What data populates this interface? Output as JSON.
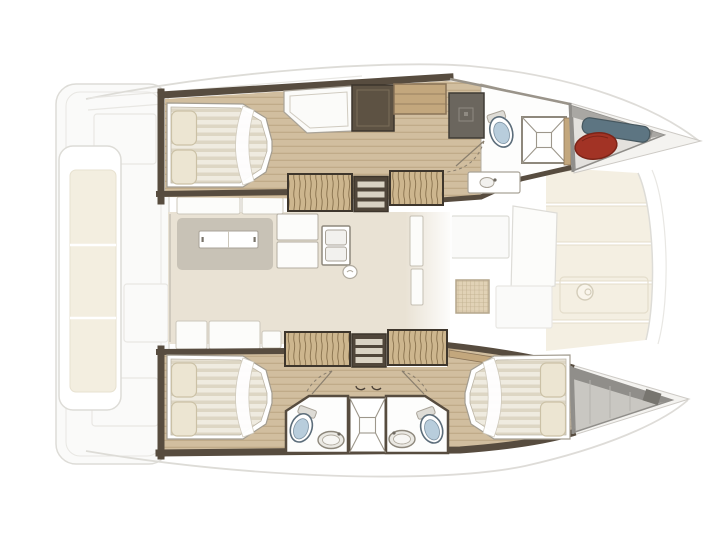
{
  "title": "Catamaran yacht interior layout floor plan, top-down view, bow to the right",
  "boat": {
    "type_label": "catamaran-floor-plan",
    "orientation": "bow-right",
    "double_beds": 3,
    "toilets": 3,
    "shower_cubicles": 2,
    "staircases": 2,
    "salon_features": [
      "dining-table",
      "settee-seats",
      "galley-double-sink",
      "galley-counters",
      "tall-cabinet"
    ],
    "port_hull_features": [
      "aft-double-bed-cabin",
      "two-pillows",
      "desk-seat",
      "wardrobe",
      "dark-cabinet",
      "staircase",
      "bathroom-toilet",
      "vanity-sink",
      "shower-cubicle",
      "bow-storage-with-red-fender-and-blue-roll"
    ],
    "starboard_hull_features": [
      "aft-double-bed-cabin",
      "staircase",
      "aft-bathroom-toilet-sink",
      "central-shower-cubicle",
      "forward-bathroom-toilet-sink",
      "forward-double-bed-cabin",
      "bow-locker"
    ],
    "exterior_features": [
      "stern-platform",
      "aft-cockpit-bench-with-cushions",
      "sheer-lines",
      "foredeck-cream-panels",
      "deck-fitting",
      "forward-cockpit-panels",
      "trampoline-mesh"
    ]
  },
  "colors": {
    "bg": "#ffffff",
    "wall": "#574c3f",
    "wall_light": "#6e6254",
    "wood": "#d1be9f",
    "wood_line": "#c0ab89",
    "stairs_bg": "#cdb68e",
    "stairs_line": "#87704c",
    "stairs_border": "#3e362c",
    "shelf_tan": "#c3a77d",
    "shelf_tan_line": "#8a7458",
    "salon_floor": "#e9e2d4",
    "table_base": "#c8c2b6",
    "white_furniture": "#fcfcfa",
    "furniture_line": "#a9a398",
    "settee_line": "#ccc7bb",
    "bed_stripe_a": "#efebe0",
    "bed_stripe_b": "#ddd6c4",
    "bed_outline": "#a39d91",
    "pillow": "#ece5d2",
    "pillow_line": "#cbc1a6",
    "bathroom_floor": "#fdfdfc",
    "bathroom_line": "#b3ada1",
    "toilet_seat": "#b8cddc",
    "toilet_line": "#5c6d7a",
    "sink_fill": "#ebe9e3",
    "sink_line": "#8e887c",
    "shower_line": "#9d978b",
    "locker_gray": "#c9c7c2",
    "locker_light": "#e3e1dd",
    "locker_band": "#908e8a",
    "locker_dark": "#77756f",
    "fender_red": "#a23325",
    "fender_red_dark": "#7c2418",
    "roll_blue": "#5d7582",
    "roll_blue_dark": "#46575f",
    "mesh_bg": "#dccbaa",
    "mesh_line": "#b3a078",
    "deck_cream": "#f3edde",
    "deck_cream_line": "#e0d8c2",
    "faded_line": "#d8d6d1",
    "faded_line_soft": "#e5e3df",
    "faded_fill": "#fafaf8",
    "cushion_cream": "#f2ecdb",
    "cushion_line": "#e3dcc8",
    "dark_cabinet": "#6b665e",
    "steps_dark": "#50463a",
    "step_strip": "#d9d2c3",
    "door_line": "#8a7f6e"
  }
}
